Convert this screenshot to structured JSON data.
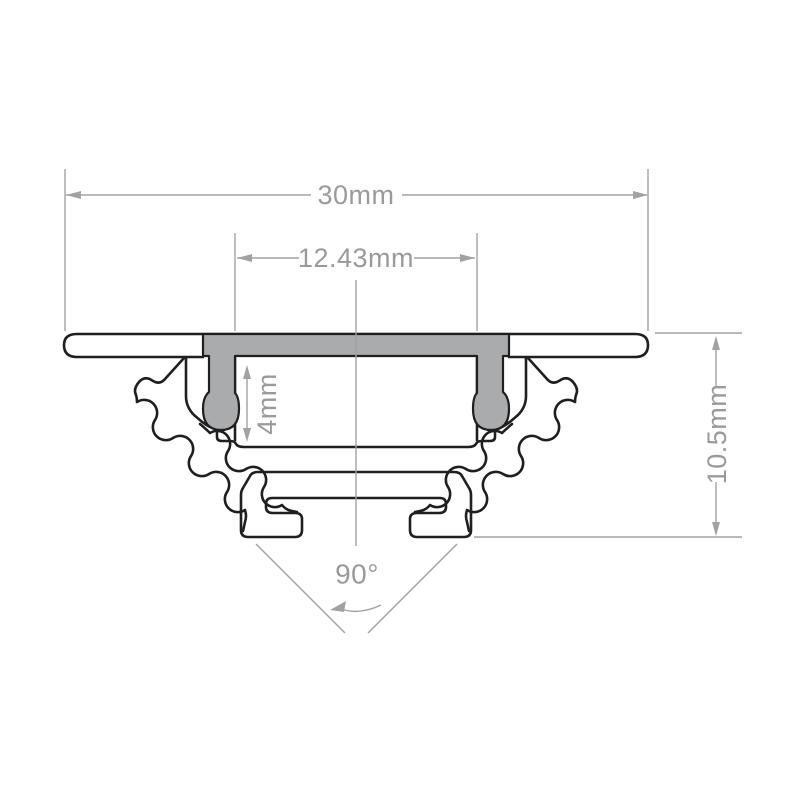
{
  "drawing": {
    "labels": {
      "overall_width": "30mm",
      "inner_opening_width": "12.43mm",
      "recess_depth": "4mm",
      "overall_height": "10.5mm",
      "corner_angle": "90°"
    },
    "colors": {
      "background": "#ffffff",
      "profile_outline": "#1f1f1f",
      "cover_fill": "#a9abac",
      "dimension_lines": "#a2a2a2",
      "dimension_text": "#9a9a9a"
    }
  }
}
